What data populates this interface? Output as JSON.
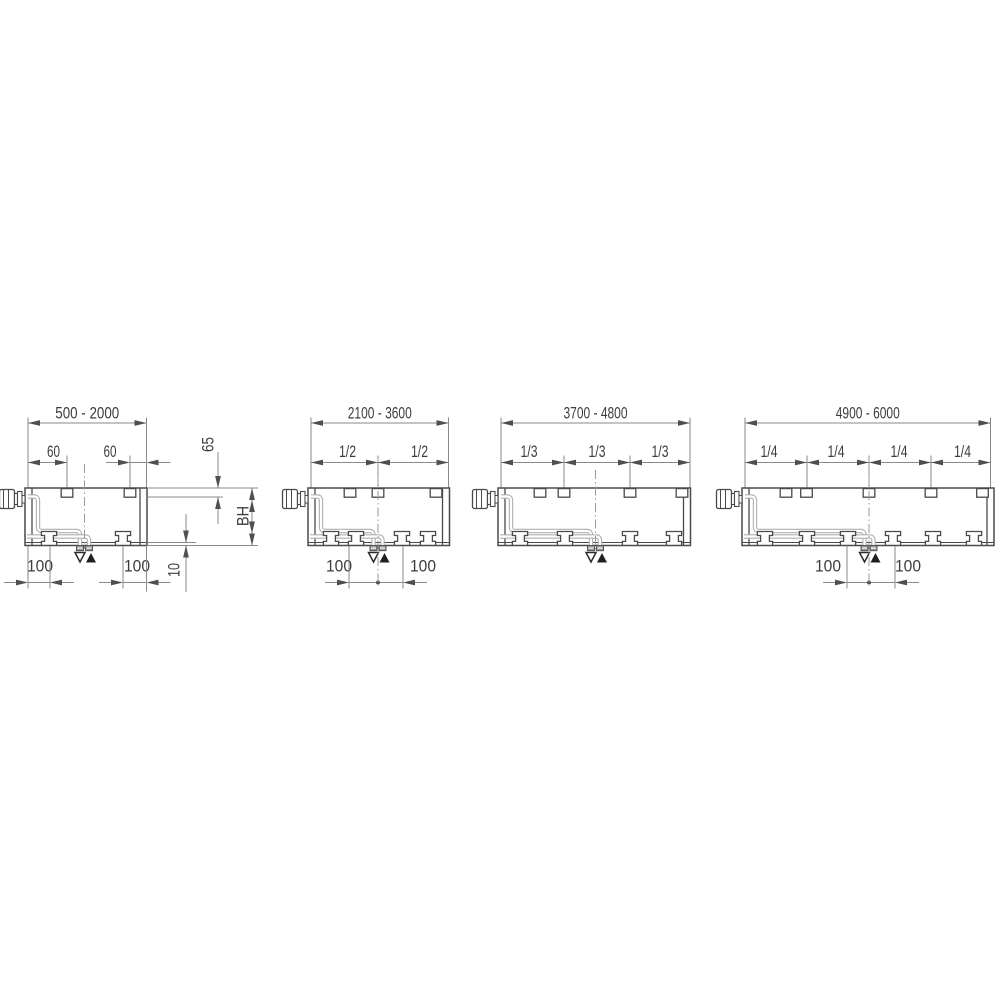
{
  "drawing": {
    "description_labels": {
      "return_marker": "outline-triangle-down",
      "flow_marker": "filled-triangle-up"
    },
    "colors": {
      "background": "#ffffff",
      "body_line": "#4a4a4a",
      "dim_line": "#8a8a8a",
      "arrow": "#4f4f4f",
      "text": "#3d3d3d",
      "pipe": "#b0b0b0",
      "stub_fill": "#9c9c9c",
      "center_line": "#9a9a9a",
      "flow_triangle": "#1f1f1f"
    },
    "diagrams": [
      {
        "name": "range-500-2000",
        "range_label": "500 - 2000",
        "body": [
          25,
          147
        ],
        "range_ticks": [
          28,
          146.5
        ],
        "tabs": [
          67,
          130
        ],
        "feet": [
          49,
          123
        ],
        "conn_x": 84.5,
        "center_line": [
          464,
          549
        ],
        "frac_dims": null,
        "tab_dims": [
          {
            "label": "60",
            "from": 28,
            "to": 67,
            "text_x": 53.5,
            "style": "inside"
          },
          {
            "label": "60",
            "from": 130,
            "to": 146.5,
            "text_x": 110,
            "style": "outside"
          }
        ],
        "bottom_dims": [
          {
            "label": "100",
            "from": 28,
            "to": 50,
            "text_x": 40,
            "style": "outside"
          },
          {
            "label": "100",
            "from": 123,
            "to": 146.5,
            "text_x": 137,
            "style": "outside"
          }
        ],
        "center_dot": false,
        "side_dims": {
          "offset_label": "65",
          "height_label": "BH",
          "foot_label": "10"
        }
      },
      {
        "name": "range-2100-3600",
        "range_label": "2100 - 3600",
        "body": [
          308,
          449.5
        ],
        "range_ticks": [
          311,
          448.5
        ],
        "tabs": [
          350,
          378,
          436
        ],
        "feet": [
          331,
          356,
          402,
          428
        ],
        "conn_x": 378,
        "center_line": [
          458,
          586
        ],
        "frac_dims": {
          "labels": [
            "1/2",
            "1/2"
          ],
          "ticks": [
            311,
            378,
            448.5
          ],
          "text_xs": [
            347.5,
            419.5
          ]
        },
        "tab_dims": null,
        "bottom_dims": [
          {
            "label": "100",
            "from": 349,
            "to": 378,
            "text_x": 339,
            "style": "outside-l"
          },
          {
            "label": "100",
            "from": 378,
            "to": 403,
            "text_x": 423,
            "style": "outside-r"
          }
        ],
        "center_dot": true,
        "side_dims": null
      },
      {
        "name": "range-3700-4800",
        "range_label": "3700 - 4800",
        "body": [
          498,
          690.5
        ],
        "range_ticks": [
          501,
          690
        ],
        "tabs": [
          540,
          564,
          630,
          682
        ],
        "feet": [
          520,
          565,
          630,
          674
        ],
        "conn_x": 595.5,
        "center_line": [
          470,
          551
        ],
        "frac_dims": {
          "labels": [
            "1/3",
            "1/3",
            "1/3"
          ],
          "ticks": [
            501,
            564,
            630,
            690
          ],
          "text_xs": [
            529,
            597,
            660
          ]
        },
        "tab_dims": null,
        "bottom_dims": null,
        "center_dot": false,
        "side_dims": null
      },
      {
        "name": "range-4900-6000",
        "range_label": "4900 - 6000",
        "body": [
          742,
          994
        ],
        "range_ticks": [
          745,
          990.5
        ],
        "tabs": [
          786,
          806.5,
          869,
          931,
          982.5
        ],
        "feet": [
          765,
          807,
          848,
          893,
          933,
          974
        ],
        "conn_x": 869,
        "center_line": [
          458,
          586
        ],
        "frac_dims": {
          "labels": [
            "1/4",
            "1/4",
            "1/4",
            "1/4"
          ],
          "ticks": [
            745,
            807,
            869,
            931,
            990.5
          ],
          "text_xs": [
            769,
            836,
            899,
            962.5
          ]
        },
        "tab_dims": null,
        "bottom_dims": [
          {
            "label": "100",
            "from": 847,
            "to": 869,
            "text_x": 828,
            "style": "outside-l"
          },
          {
            "label": "100",
            "from": 869,
            "to": 895,
            "text_x": 908,
            "style": "outside-r"
          }
        ],
        "center_dot": true,
        "side_dims": null
      }
    ]
  }
}
